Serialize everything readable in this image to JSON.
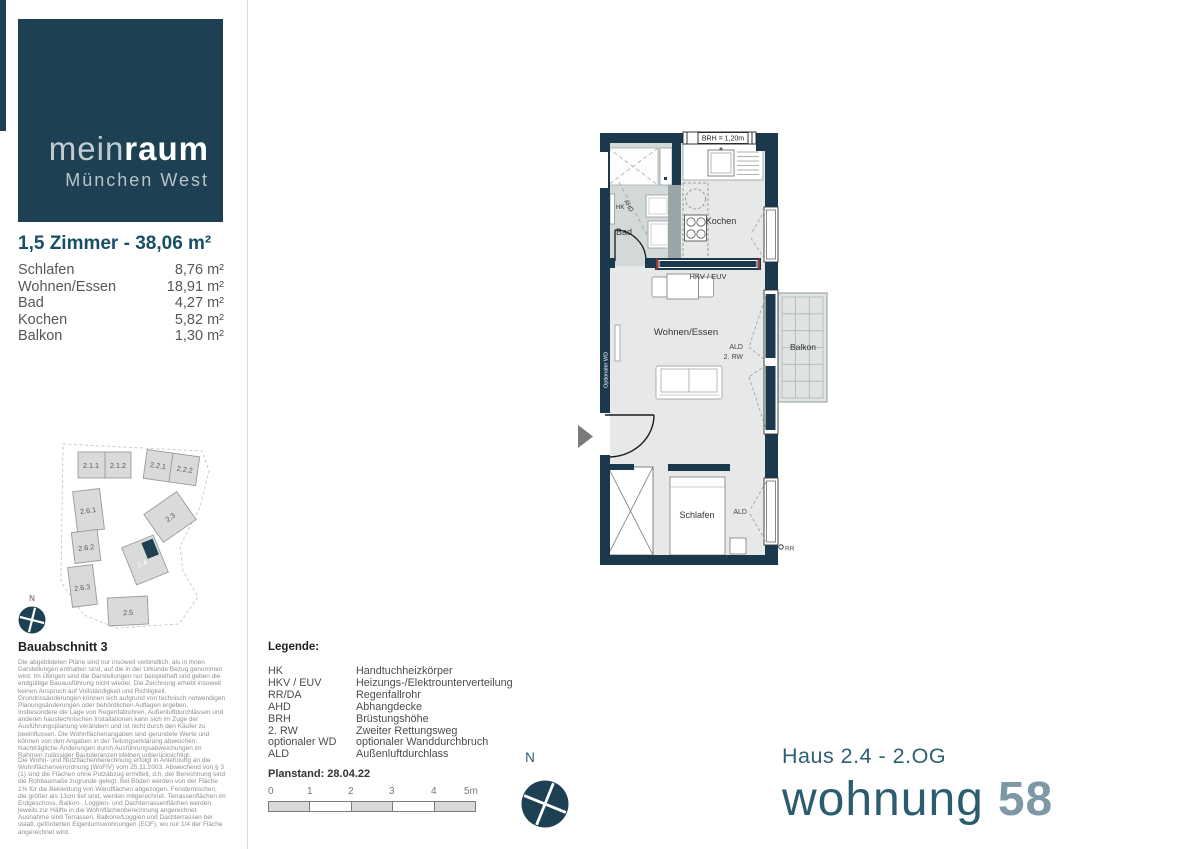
{
  "logo": {
    "brand_light": "mein",
    "brand_bold": "raum",
    "subtitle": "München West"
  },
  "sidebar": {
    "apartment_title": "1,5 Zimmer - 38,06 m²",
    "rooms": [
      {
        "label": "Schlafen",
        "area": "8,76 m²"
      },
      {
        "label": "Wohnen/Essen",
        "area": "18,91 m²"
      },
      {
        "label": "Bad",
        "area": "4,27 m²"
      },
      {
        "label": "Kochen",
        "area": "5,82 m²"
      },
      {
        "label": "Balkon",
        "area": "1,30 m²"
      }
    ],
    "section_title": "Bauabschnitt 3",
    "disclaimer1": "Die abgebildeten Pläne sind nur insoweit verbindlich, als in ihnen Darstellungen enthalten sind, auf die in der Urkunde Bezug genommen wird. Im Übrigen sind die Darstellungen nur beispielhaft und geben die endgültige Bauausführung nicht wieder. Die Zeichnung erhebt insoweit keinen Anspruch auf Vollständigkeit und Richtigkeit. Grundrissänderungen können sich aufgrund von technisch notwendigen Planungsänderungen oder behördlichen Auflagen ergeben. Insbesondere die Lage von Regenfallrohren, Außenluftdurchlässen und anderen haustechnischen Installationen kann sich im Zuge der Ausführungsplanung verändern und ist nicht durch den Käufer zu beeinflussen. Die Wohnflächenangaben sind gerundete Werte und können von den Angaben in der Teilungserklärung abweichen. Nachträgliche Änderungen durch Ausführungsabweichungen im Rahmen zulässiger Bautoleranzen bleiben unberücksichtigt.",
    "disclaimer2": "Die Wohn- und Nutzflächenberechnung erfolgt in Anlehnung an die Wohnflächenverordnung (WoFlV) vom 25.11.2003. Abweichend von § 3 (1) sind die Flächen ohne Putzabzug ermittelt, d.h. der Berechnung sind die Rohbaumaße zugrunde gelegt. Bei Böden werden von der Fläche 1% für die Bekleidung von Wandflächen abgezogen. Fensternischen, die größer als 13cm tief sind, werden mitgerechnet. Terrassenflächen im Erdgeschoss, Balkon-, Loggien- und Dachterrassenflächen werden jeweils zur Hälfte in die Wohnflächenberechnung angerechnet. Ausnahme sind Terrassen, Balkone/Loggien und Dachterrassen bei staatl. geförderten Eigentumswohnungen (EOF), wo nur 1/4 der Fläche angerechnet wird."
  },
  "site": {
    "b211": "2.1.1",
    "b212": "2.1.2",
    "b221": "2.2.1",
    "b222": "2.2.2",
    "b261": "2.6.1",
    "b262": "2.6.2",
    "b263": "2.6.3",
    "b23": "2.3",
    "b24": "2.4",
    "b25": "2.5",
    "compass_label": "N"
  },
  "plan": {
    "bad": "Bad",
    "kochen": "Kochen",
    "wohnen": "Wohnen/Essen",
    "schlafen": "Schlafen",
    "balkon": "Balkon",
    "hk": "HK",
    "ahd": "AHD",
    "hkv": "HKV / EUV",
    "brh": "BRH = 1,20m",
    "wd": "Optionaler WD",
    "ald": "ALD",
    "rw2": "2. RW",
    "ald2": "ALD",
    "rr": "RR"
  },
  "legend": {
    "title": "Legende:",
    "items": [
      {
        "abbr": "HK",
        "meaning": "Handtuchheizkörper"
      },
      {
        "abbr": "HKV / EUV",
        "meaning": "Heizungs-/Elektrounterverteilung"
      },
      {
        "abbr": "RR/DA",
        "meaning": "Regenfallrohr"
      },
      {
        "abbr": "AHD",
        "meaning": "Abhangdecke"
      },
      {
        "abbr": "BRH",
        "meaning": "Brüstungshöhe"
      },
      {
        "abbr": "2. RW",
        "meaning": "Zweiter Rettungsweg"
      },
      {
        "abbr": "optionaler WD",
        "meaning": "optionaler Wanddurchbruch"
      },
      {
        "abbr": "ALD",
        "meaning": "Außenluftdurchlass"
      }
    ]
  },
  "footer": {
    "planstand": "Planstand: 28.04.22",
    "scale_ticks": [
      "0",
      "1",
      "2",
      "3",
      "4",
      "5m"
    ],
    "compass_label": "N"
  },
  "title": {
    "haus": "Haus 2.4 - 2.OG",
    "wohnung": "wohnung",
    "number": "58"
  },
  "colors": {
    "wall": "#1b394d",
    "brand": "#1d4152",
    "teal_title": "#2b5c70",
    "number_gray": "#7e99a6"
  }
}
